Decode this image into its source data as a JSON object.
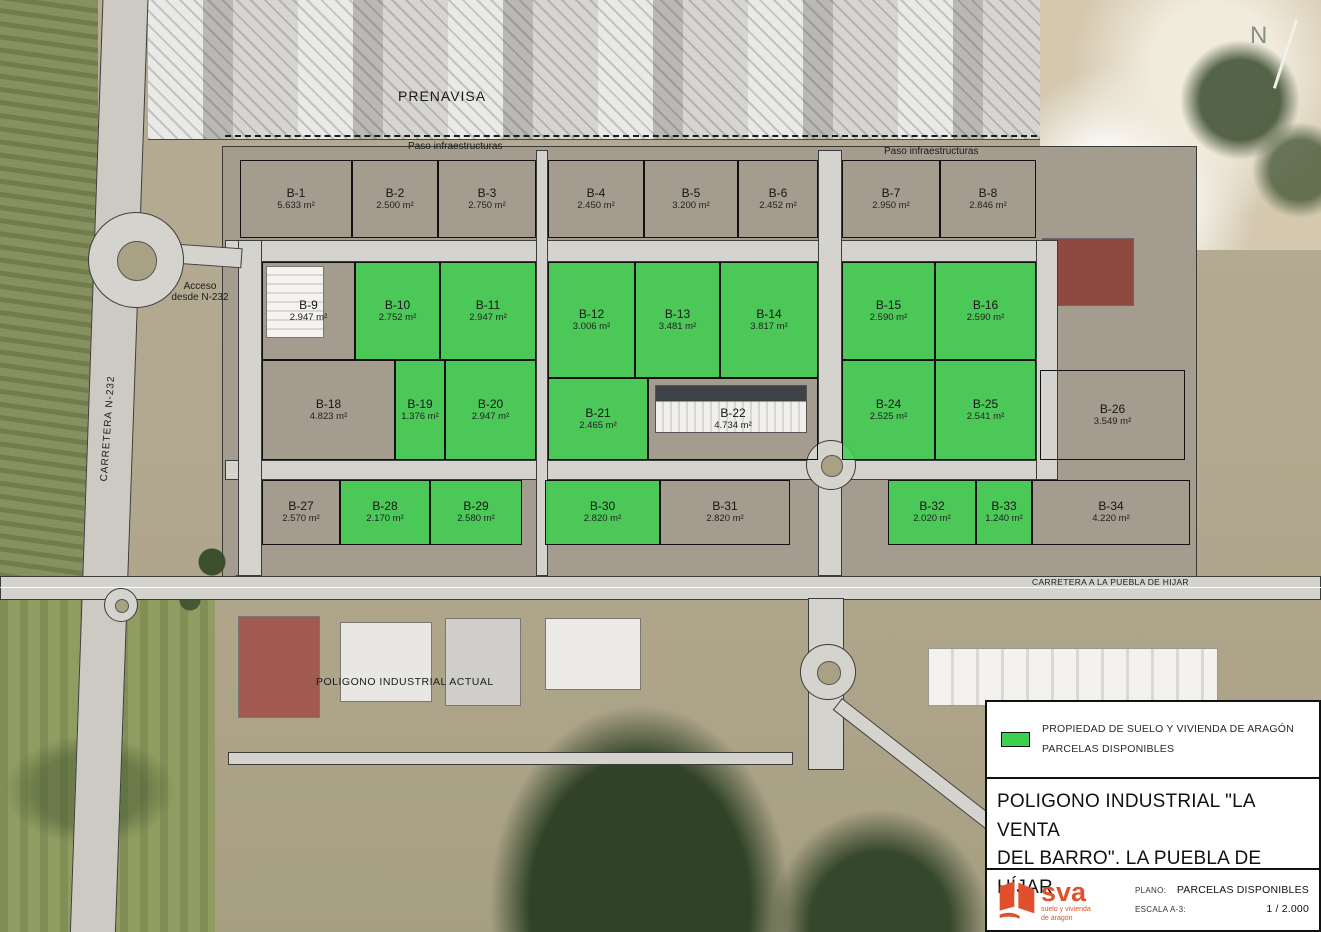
{
  "map": {
    "north_label": "N",
    "available_color": "#3dd04f",
    "labels": {
      "prenavisa": "PRENAVISA",
      "paso_left": "Paso infraestructuras",
      "paso_right": "Paso infraestructuras",
      "acceso": "Acceso\ndesde N-232",
      "carretera_n232": "CARRETERA   N-232",
      "carretera_puebla": "CARRETERA A LA PUEBLA DE HIJAR",
      "poligono_actual": "POLIGONO INDUSTRIAL ACTUAL"
    },
    "parcels": [
      {
        "label": "B-1",
        "area": "5.633 m²",
        "available": false,
        "x": 240,
        "y": 160,
        "w": 112,
        "h": 78
      },
      {
        "label": "B-2",
        "area": "2.500 m²",
        "available": false,
        "x": 352,
        "y": 160,
        "w": 86,
        "h": 78
      },
      {
        "label": "B-3",
        "area": "2.750 m²",
        "available": false,
        "x": 438,
        "y": 160,
        "w": 98,
        "h": 78
      },
      {
        "label": "B-4",
        "area": "2.450 m²",
        "available": false,
        "x": 548,
        "y": 160,
        "w": 96,
        "h": 78
      },
      {
        "label": "B-5",
        "area": "3.200 m²",
        "available": false,
        "x": 644,
        "y": 160,
        "w": 94,
        "h": 78
      },
      {
        "label": "B-6",
        "area": "2.452 m²",
        "available": false,
        "x": 738,
        "y": 160,
        "w": 80,
        "h": 78
      },
      {
        "label": "B-7",
        "area": "2.950 m²",
        "available": false,
        "x": 842,
        "y": 160,
        "w": 98,
        "h": 78
      },
      {
        "label": "B-8",
        "area": "2.846 m²",
        "available": false,
        "x": 940,
        "y": 160,
        "w": 96,
        "h": 78
      },
      {
        "label": "B-9",
        "area": "2.947 m²",
        "available": false,
        "x": 262,
        "y": 262,
        "w": 93,
        "h": 98
      },
      {
        "label": "B-10",
        "area": "2.752 m²",
        "available": true,
        "x": 355,
        "y": 262,
        "w": 85,
        "h": 98
      },
      {
        "label": "B-11",
        "area": "2.947 m²",
        "available": true,
        "x": 440,
        "y": 262,
        "w": 96,
        "h": 98
      },
      {
        "label": "B-12",
        "area": "3.006 m²",
        "available": true,
        "x": 548,
        "y": 262,
        "w": 87,
        "h": 116
      },
      {
        "label": "B-13",
        "area": "3.481 m²",
        "available": true,
        "x": 635,
        "y": 262,
        "w": 85,
        "h": 116
      },
      {
        "label": "B-14",
        "area": "3.817 m²",
        "available": true,
        "x": 720,
        "y": 262,
        "w": 98,
        "h": 116
      },
      {
        "label": "B-15",
        "area": "2.590 m²",
        "available": true,
        "x": 842,
        "y": 262,
        "w": 93,
        "h": 98
      },
      {
        "label": "B-16",
        "area": "2.590 m²",
        "available": true,
        "x": 935,
        "y": 262,
        "w": 101,
        "h": 98
      },
      {
        "label": "B-18",
        "area": "4.823 m²",
        "available": false,
        "x": 262,
        "y": 360,
        "w": 133,
        "h": 100
      },
      {
        "label": "B-19",
        "area": "1.376 m²",
        "available": true,
        "x": 395,
        "y": 360,
        "w": 50,
        "h": 100
      },
      {
        "label": "B-20",
        "area": "2.947 m²",
        "available": true,
        "x": 445,
        "y": 360,
        "w": 91,
        "h": 100
      },
      {
        "label": "B-21",
        "area": "2.465 m²",
        "available": true,
        "x": 548,
        "y": 378,
        "w": 100,
        "h": 82
      },
      {
        "label": "B-22",
        "area": "4.734 m²",
        "available": false,
        "x": 648,
        "y": 378,
        "w": 170,
        "h": 82
      },
      {
        "label": "B-24",
        "area": "2.525 m²",
        "available": true,
        "x": 842,
        "y": 360,
        "w": 93,
        "h": 100
      },
      {
        "label": "B-25",
        "area": "2.541 m²",
        "available": true,
        "x": 935,
        "y": 360,
        "w": 101,
        "h": 100
      },
      {
        "label": "B-26",
        "area": "3.549 m²",
        "available": false,
        "x": 1040,
        "y": 370,
        "w": 145,
        "h": 90
      },
      {
        "label": "B-27",
        "area": "2.570 m²",
        "available": false,
        "x": 262,
        "y": 480,
        "w": 78,
        "h": 65
      },
      {
        "label": "B-28",
        "area": "2.170 m²",
        "available": true,
        "x": 340,
        "y": 480,
        "w": 90,
        "h": 65
      },
      {
        "label": "B-29",
        "area": "2.580 m²",
        "available": true,
        "x": 430,
        "y": 480,
        "w": 92,
        "h": 65
      },
      {
        "label": "B-30",
        "area": "2.820 m²",
        "available": true,
        "x": 545,
        "y": 480,
        "w": 115,
        "h": 65
      },
      {
        "label": "B-31",
        "area": "2.820 m²",
        "available": false,
        "x": 660,
        "y": 480,
        "w": 130,
        "h": 65
      },
      {
        "label": "B-32",
        "area": "2.020 m²",
        "available": true,
        "x": 888,
        "y": 480,
        "w": 88,
        "h": 65
      },
      {
        "label": "B-33",
        "area": "1.240 m²",
        "available": true,
        "x": 976,
        "y": 480,
        "w": 56,
        "h": 65
      },
      {
        "label": "B-34",
        "area": "4.220 m²",
        "available": false,
        "x": 1032,
        "y": 480,
        "w": 158,
        "h": 65
      }
    ]
  },
  "legend": {
    "swatch_color": "#3dd04f",
    "line1": "PROPIEDAD DE SUELO Y VIVIENDA DE ARAGÓN",
    "line2": "PARCELAS DISPONIBLES"
  },
  "titleblock": {
    "title_line1": "POLIGONO INDUSTRIAL \"LA VENTA",
    "title_line2": "DEL BARRO\".   LA PUEBLA DE HÍJAR",
    "plano_label": "PLANO:",
    "plano_value": "PARCELAS DISPONIBLES",
    "escala_label": "ESCALA A-3:",
    "escala_value": "1 / 2.000",
    "logo_text": "sva",
    "logo_tagline": "suelo y vivienda\nde aragón",
    "logo_color": "#e0502c"
  }
}
